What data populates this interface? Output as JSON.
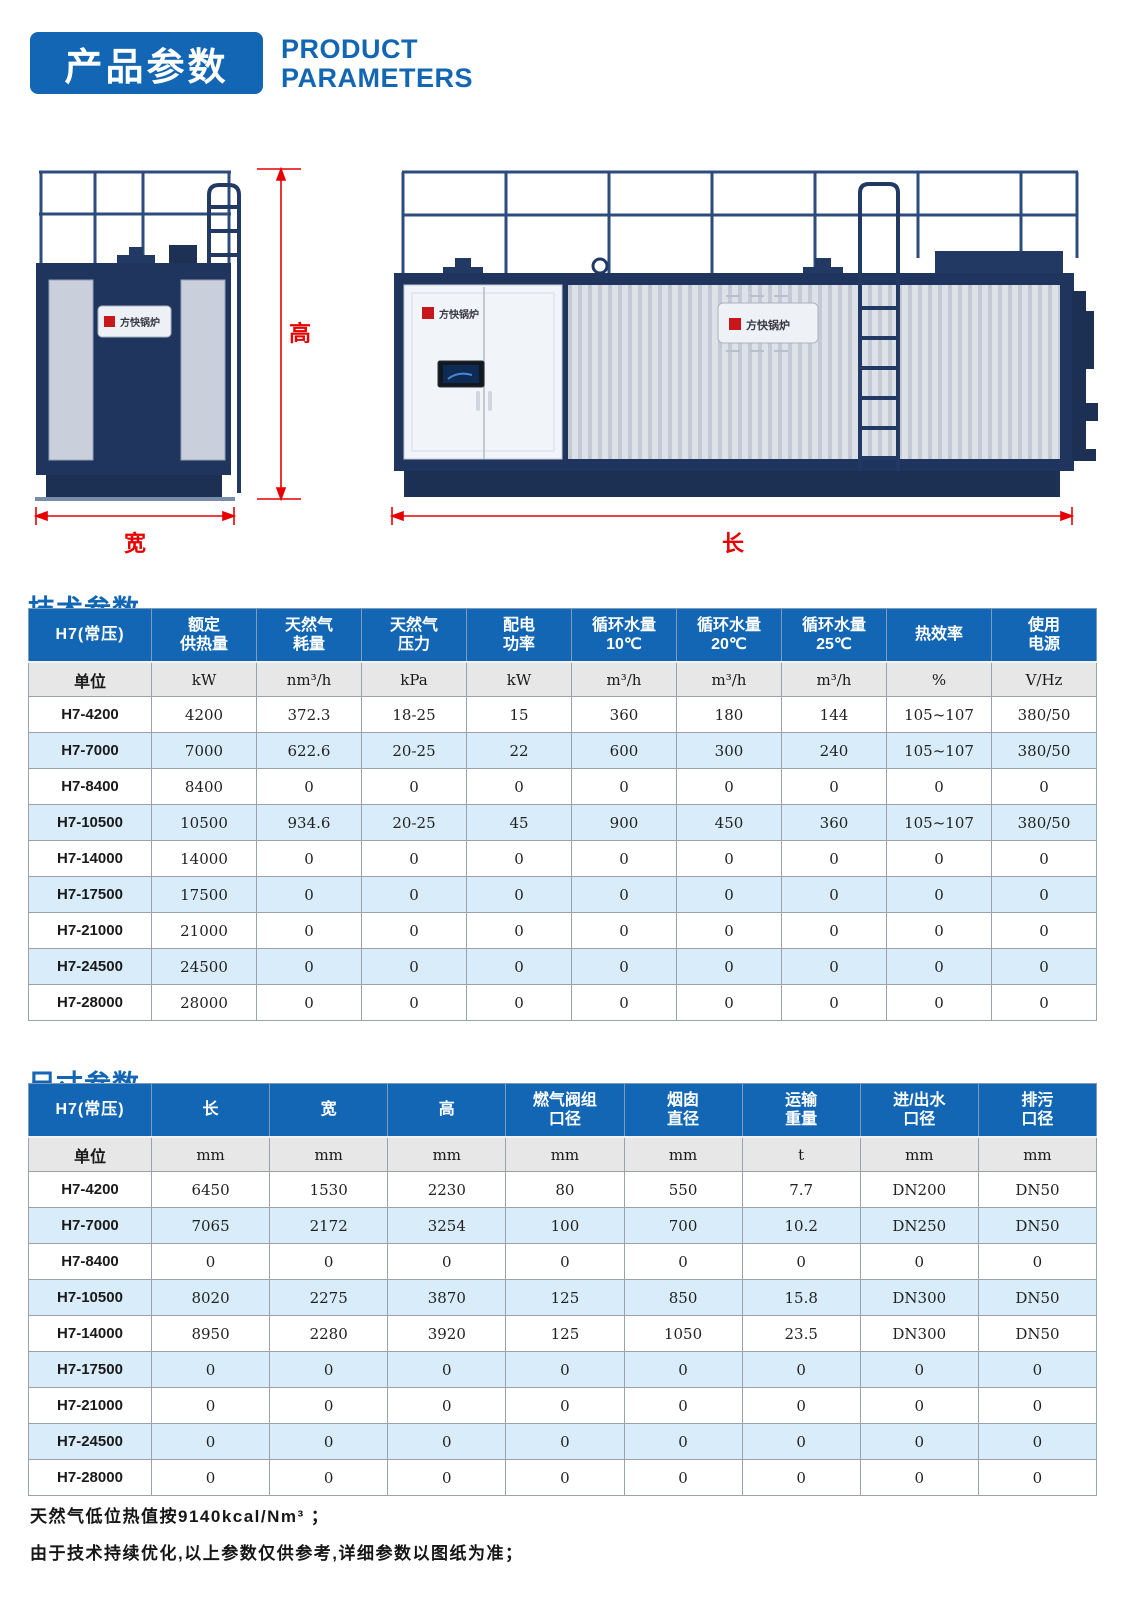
{
  "colors": {
    "brand_blue": "#1266b4",
    "dimension_red": "#e60000",
    "boiler_navy": "#20355e",
    "row_alt_blue": "#d9ecf9"
  },
  "header": {
    "title_cn": "产品参数",
    "title_en_line1": "PRODUCT",
    "title_en_line2": "PARAMETERS"
  },
  "drawings": {
    "front_view": {
      "height_label": "高",
      "width_label": "宽",
      "brand_plate": "方快锅炉"
    },
    "side_view": {
      "length_label": "长",
      "brand_plate": "方快锅炉",
      "cabinet_brand": "方快锅炉"
    }
  },
  "tables": [
    {
      "id": "tech",
      "section_title": "技术参数",
      "corner": "H7(常压)",
      "unit_label": "单位",
      "columns": [
        {
          "label": "额定\n供热量",
          "unit": "kW"
        },
        {
          "label": "天然气\n耗量",
          "unit": "nm³/h"
        },
        {
          "label": "天然气\n压力",
          "unit": "kPa"
        },
        {
          "label": "配电\n功率",
          "unit": "kW"
        },
        {
          "label": "循环水量\n10℃",
          "unit": "m³/h"
        },
        {
          "label": "循环水量\n20℃",
          "unit": "m³/h"
        },
        {
          "label": "循环水量\n25℃",
          "unit": "m³/h"
        },
        {
          "label": "热效率",
          "unit": "%"
        },
        {
          "label": "使用\n电源",
          "unit": "V/Hz"
        }
      ],
      "rows": [
        {
          "model": "H7-4200",
          "values": [
            "4200",
            "372.3",
            "18-25",
            "15",
            "360",
            "180",
            "144",
            "105~107",
            "380/50"
          ]
        },
        {
          "model": "H7-7000",
          "values": [
            "7000",
            "622.6",
            "20-25",
            "22",
            "600",
            "300",
            "240",
            "105~107",
            "380/50"
          ]
        },
        {
          "model": "H7-8400",
          "values": [
            "8400",
            "0",
            "0",
            "0",
            "0",
            "0",
            "0",
            "0",
            "0"
          ]
        },
        {
          "model": "H7-10500",
          "values": [
            "10500",
            "934.6",
            "20-25",
            "45",
            "900",
            "450",
            "360",
            "105~107",
            "380/50"
          ]
        },
        {
          "model": "H7-14000",
          "values": [
            "14000",
            "0",
            "0",
            "0",
            "0",
            "0",
            "0",
            "0",
            "0"
          ]
        },
        {
          "model": "H7-17500",
          "values": [
            "17500",
            "0",
            "0",
            "0",
            "0",
            "0",
            "0",
            "0",
            "0"
          ]
        },
        {
          "model": "H7-21000",
          "values": [
            "21000",
            "0",
            "0",
            "0",
            "0",
            "0",
            "0",
            "0",
            "0"
          ]
        },
        {
          "model": "H7-24500",
          "values": [
            "24500",
            "0",
            "0",
            "0",
            "0",
            "0",
            "0",
            "0",
            "0"
          ]
        },
        {
          "model": "H7-28000",
          "values": [
            "28000",
            "0",
            "0",
            "0",
            "0",
            "0",
            "0",
            "0",
            "0"
          ]
        }
      ]
    },
    {
      "id": "dims",
      "section_title": "尺寸参数",
      "corner": "H7(常压)",
      "unit_label": "单位",
      "columns": [
        {
          "label": "长",
          "unit": "mm"
        },
        {
          "label": "宽",
          "unit": "mm"
        },
        {
          "label": "高",
          "unit": "mm"
        },
        {
          "label": "燃气阀组\n口径",
          "unit": "mm"
        },
        {
          "label": "烟囱\n直径",
          "unit": "mm"
        },
        {
          "label": "运输\n重量",
          "unit": "t"
        },
        {
          "label": "进/出水\n口径",
          "unit": "mm"
        },
        {
          "label": "排污\n口径",
          "unit": "mm"
        }
      ],
      "rows": [
        {
          "model": "H7-4200",
          "values": [
            "6450",
            "1530",
            "2230",
            "80",
            "550",
            "7.7",
            "DN200",
            "DN50"
          ]
        },
        {
          "model": "H7-7000",
          "values": [
            "7065",
            "2172",
            "3254",
            "100",
            "700",
            "10.2",
            "DN250",
            "DN50"
          ]
        },
        {
          "model": "H7-8400",
          "values": [
            "0",
            "0",
            "0",
            "0",
            "0",
            "0",
            "0",
            "0"
          ]
        },
        {
          "model": "H7-10500",
          "values": [
            "8020",
            "2275",
            "3870",
            "125",
            "850",
            "15.8",
            "DN300",
            "DN50"
          ]
        },
        {
          "model": "H7-14000",
          "values": [
            "8950",
            "2280",
            "3920",
            "125",
            "1050",
            "23.5",
            "DN300",
            "DN50"
          ]
        },
        {
          "model": "H7-17500",
          "values": [
            "0",
            "0",
            "0",
            "0",
            "0",
            "0",
            "0",
            "0"
          ]
        },
        {
          "model": "H7-21000",
          "values": [
            "0",
            "0",
            "0",
            "0",
            "0",
            "0",
            "0",
            "0"
          ]
        },
        {
          "model": "H7-24500",
          "values": [
            "0",
            "0",
            "0",
            "0",
            "0",
            "0",
            "0",
            "0"
          ]
        },
        {
          "model": "H7-28000",
          "values": [
            "0",
            "0",
            "0",
            "0",
            "0",
            "0",
            "0",
            "0"
          ]
        }
      ]
    }
  ],
  "footnotes": [
    "天然气低位热值按9140kcal/Nm³ ；",
    "由于技术持续优化,以上参数仅供参考,详细参数以图纸为准；"
  ]
}
